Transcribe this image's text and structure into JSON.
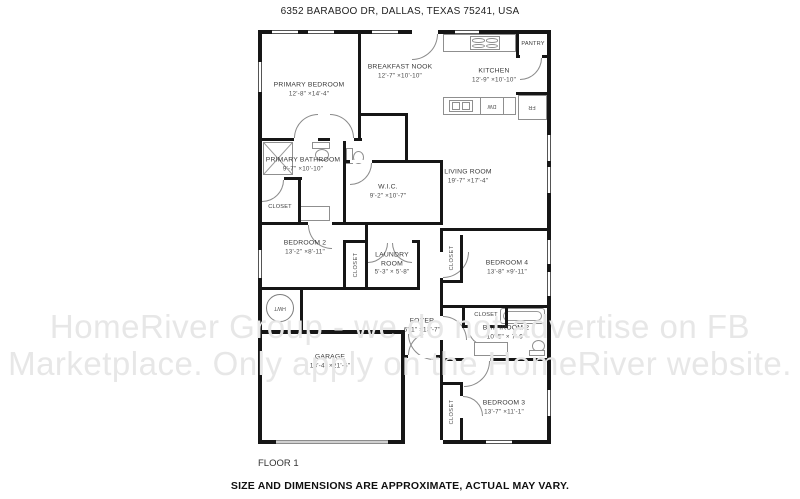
{
  "header": {
    "address": "6352 BARABOO DR, DALLAS, TEXAS 75241, USA"
  },
  "footer": {
    "floor_label": "FLOOR 1",
    "disclaimer": "SIZE AND DIMENSIONS ARE APPROXIMATE, ACTUAL MAY VARY."
  },
  "watermark": {
    "line1": "HomeRiver Group - we do not advertise on FB",
    "line2": "Marketplace. Only apply on the HomeRiver website."
  },
  "rooms": {
    "primary_bedroom": {
      "name": "PRIMARY BEDROOM",
      "dims": "12'-8\" ×14'-4\""
    },
    "breakfast_nook": {
      "name": "BREAKFAST NOOK",
      "dims": "12'-7\" ×10'-10\""
    },
    "kitchen": {
      "name": "KITCHEN",
      "dims": "12'-9\" ×10'-10\""
    },
    "living_room": {
      "name": "LIVING ROOM",
      "dims": "19'-7\" ×17'-4\""
    },
    "primary_bathroom": {
      "name": "PRIMARY BATHROOM",
      "dims": "9'-7\" ×10'-10\""
    },
    "wic": {
      "name": "W.I.C.",
      "dims": "9'-2\" ×10'-7\""
    },
    "bedroom2": {
      "name": "BEDROOM 2",
      "dims": "13'-2\" ×8'-11\""
    },
    "laundry": {
      "name": "LAUNDRY ROOM",
      "dims": "5'-3\" × 5'-8\""
    },
    "bedroom4": {
      "name": "BEDROOM 4",
      "dims": "13'-8\" ×9'-11\""
    },
    "foyer": {
      "name": "FOYER",
      "dims": "6'-1\" ×13'-7\""
    },
    "bathroom2": {
      "name": "BATHROOM 2",
      "dims": "10'-5\" × 7'-6\""
    },
    "garage": {
      "name": "GARAGE",
      "dims": "18'-4\" ×21'-6\""
    },
    "bedroom3": {
      "name": "BEDROOM 3",
      "dims": "13'-7\" ×11'-1\""
    }
  },
  "labels": {
    "pantry": "PANTRY",
    "closet": "CLOSET",
    "hwt": "HWT",
    "dw": "DW",
    "fr": "FR"
  },
  "colors": {
    "wall": "#161616",
    "watermark": "#e7e7e7",
    "fixture_outline": "#8f8f8f"
  }
}
